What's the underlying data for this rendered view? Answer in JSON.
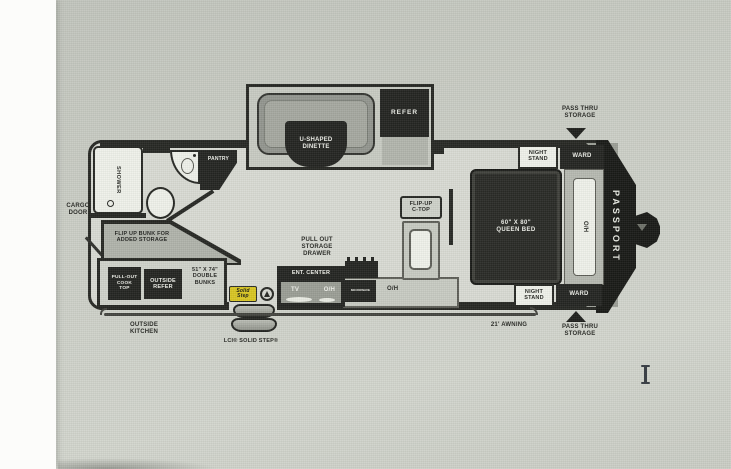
{
  "scene": {
    "background_color": "#c9ccc4",
    "page_edge_color": "#fcfcfa",
    "cursor": "text-ibeam"
  },
  "plan": {
    "colors": {
      "wall_dark": "#22231f",
      "floor": "#d7d9d2",
      "fixture_white": "#eef0e9",
      "badge_yellow": "#d7c41e",
      "cabinet_gray": "#c6c9c1"
    },
    "brand": "PASSPORT",
    "exterior": {
      "pass_thru_top": "PASS THRU\nSTORAGE",
      "pass_thru_bottom": "PASS THRU\nSTORAGE",
      "awning": "21' AWNING",
      "cargo_door": "CARGO\nDOOR",
      "outside_kitchen": "OUTSIDE\nKITCHEN",
      "step_brand": "LCI® SOLID STEP®",
      "step_logo": "Solid\nStep"
    },
    "slideout": {
      "dinette": "U-SHAPED\nDINETTE",
      "refer": "REFER"
    },
    "bath": {
      "shower": "SHOWER",
      "pantry": "PANTRY"
    },
    "bunk_area": {
      "flip_up_bunk": "FLIP UP BUNK FOR\nADDED STORAGE",
      "double_bunks": "51\" X 74\"\nDOUBLE\nBUNKS",
      "cook_top": "PULL-OUT\nCOOK\nTOP",
      "outside_refer": "OUTSIDE\nREFER"
    },
    "galley": {
      "storage_drawer": "PULL OUT\nSTORAGE\nDRAWER",
      "ent_center": "ENT. CENTER",
      "tv": "TV",
      "oh_ent": "O/H",
      "microwave": "MICROWAVE",
      "oh_counter": "O/H",
      "flip_up_ctop": "FLIP-UP\nC-TOP"
    },
    "bedroom": {
      "queen_bed": "60\" X 80\"\nQUEEN BED",
      "overhead": "O/H",
      "night_stand_top": "NIGHT\nSTAND",
      "ward_top": "WARD",
      "night_stand_bottom": "NIGHT\nSTAND",
      "ward_bottom": "WARD"
    }
  }
}
